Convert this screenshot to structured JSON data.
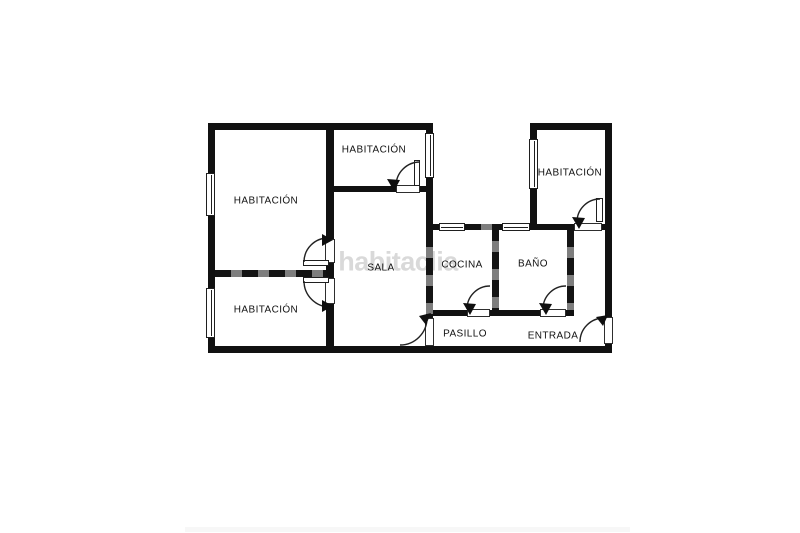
{
  "diagram": {
    "kind": "apartment-floor-plan",
    "watermark": "habitaclia",
    "rooms": [
      {
        "id": "bedroom-left-top",
        "label": "HABITACIÓN"
      },
      {
        "id": "bedroom-left-bottom",
        "label": "HABITACIÓN"
      },
      {
        "id": "bedroom-middle",
        "label": "HABITACIÓN"
      },
      {
        "id": "bedroom-top-right",
        "label": "HABITACIÓN"
      },
      {
        "id": "living-room",
        "label": "SALA"
      },
      {
        "id": "kitchen",
        "label": "COCINA"
      },
      {
        "id": "bathroom",
        "label": "BAÑO"
      },
      {
        "id": "hallway",
        "label": "PASILLO"
      },
      {
        "id": "entrance",
        "label": "ENTRADA"
      }
    ],
    "doors": [
      "bedroom-left-top-door",
      "bedroom-left-bottom-door",
      "bedroom-middle-door",
      "bedroom-top-right-door",
      "kitchen-door",
      "bathroom-door",
      "living-room-hallway-door",
      "entrance-door"
    ],
    "windows": [
      "bedroom-left-top-window",
      "bedroom-left-bottom-window",
      "bedroom-middle-window",
      "bedroom-top-right-window",
      "kitchen-window",
      "bathroom-window"
    ],
    "colors": {
      "background": "#ffffff",
      "wall": "#111111",
      "wall_accent_gray": "#7e7e7e",
      "door_line": "#222222",
      "label_text": "#111111",
      "watermark_gray": "#d9d9d9",
      "footer_strip": "#f7f7f7"
    }
  }
}
